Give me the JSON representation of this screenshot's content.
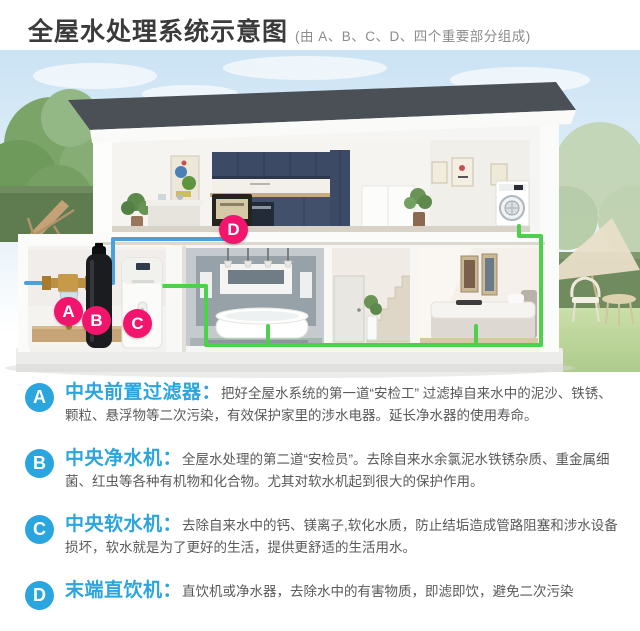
{
  "header": {
    "title": "全屋水处理系统示意图",
    "subtitle": "(由 A、B、C、D、四个重要部分组成)"
  },
  "colors": {
    "accent_blue": "#2AA5DE",
    "marker_pink": "#F1156E",
    "pipe_blue": "#4AA0DC",
    "pipe_green": "#4ED04E",
    "roof_charcoal": "#4B5056"
  },
  "diagram": {
    "markers": [
      {
        "label": "A"
      },
      {
        "label": "B"
      },
      {
        "label": "C"
      },
      {
        "label": "D"
      }
    ]
  },
  "legend": {
    "items": [
      {
        "id": "A",
        "title": "中央前置过滤器：",
        "desc": "把好全屋水系统的第一道“安检工” 过滤掉自来水中的泥沙、铁锈、颗粒、悬浮物等二次污染，有效保护家里的涉水电器。延长净水器的使用寿命。"
      },
      {
        "id": "B",
        "title": "中央净水机：",
        "desc": "全屋水处理的第二道“安检员”。去除自来水余氯泥水铁锈杂质、重金属细菌、红虫等各种有机物和化合物。尤其对软水机起到很大的保护作用。"
      },
      {
        "id": "C",
        "title": "中央软水机：",
        "desc": "去除自来水中的钙、镁离子,软化水质，防止结垢造成管路阻塞和涉水设备损坏，软水就是为了更好的生活，提供更舒适的生活用水。"
      },
      {
        "id": "D",
        "title": "末端直饮机：",
        "desc": "直饮机或净水器，去除水中的有害物质，即滤即饮，避免二次污染"
      }
    ]
  }
}
